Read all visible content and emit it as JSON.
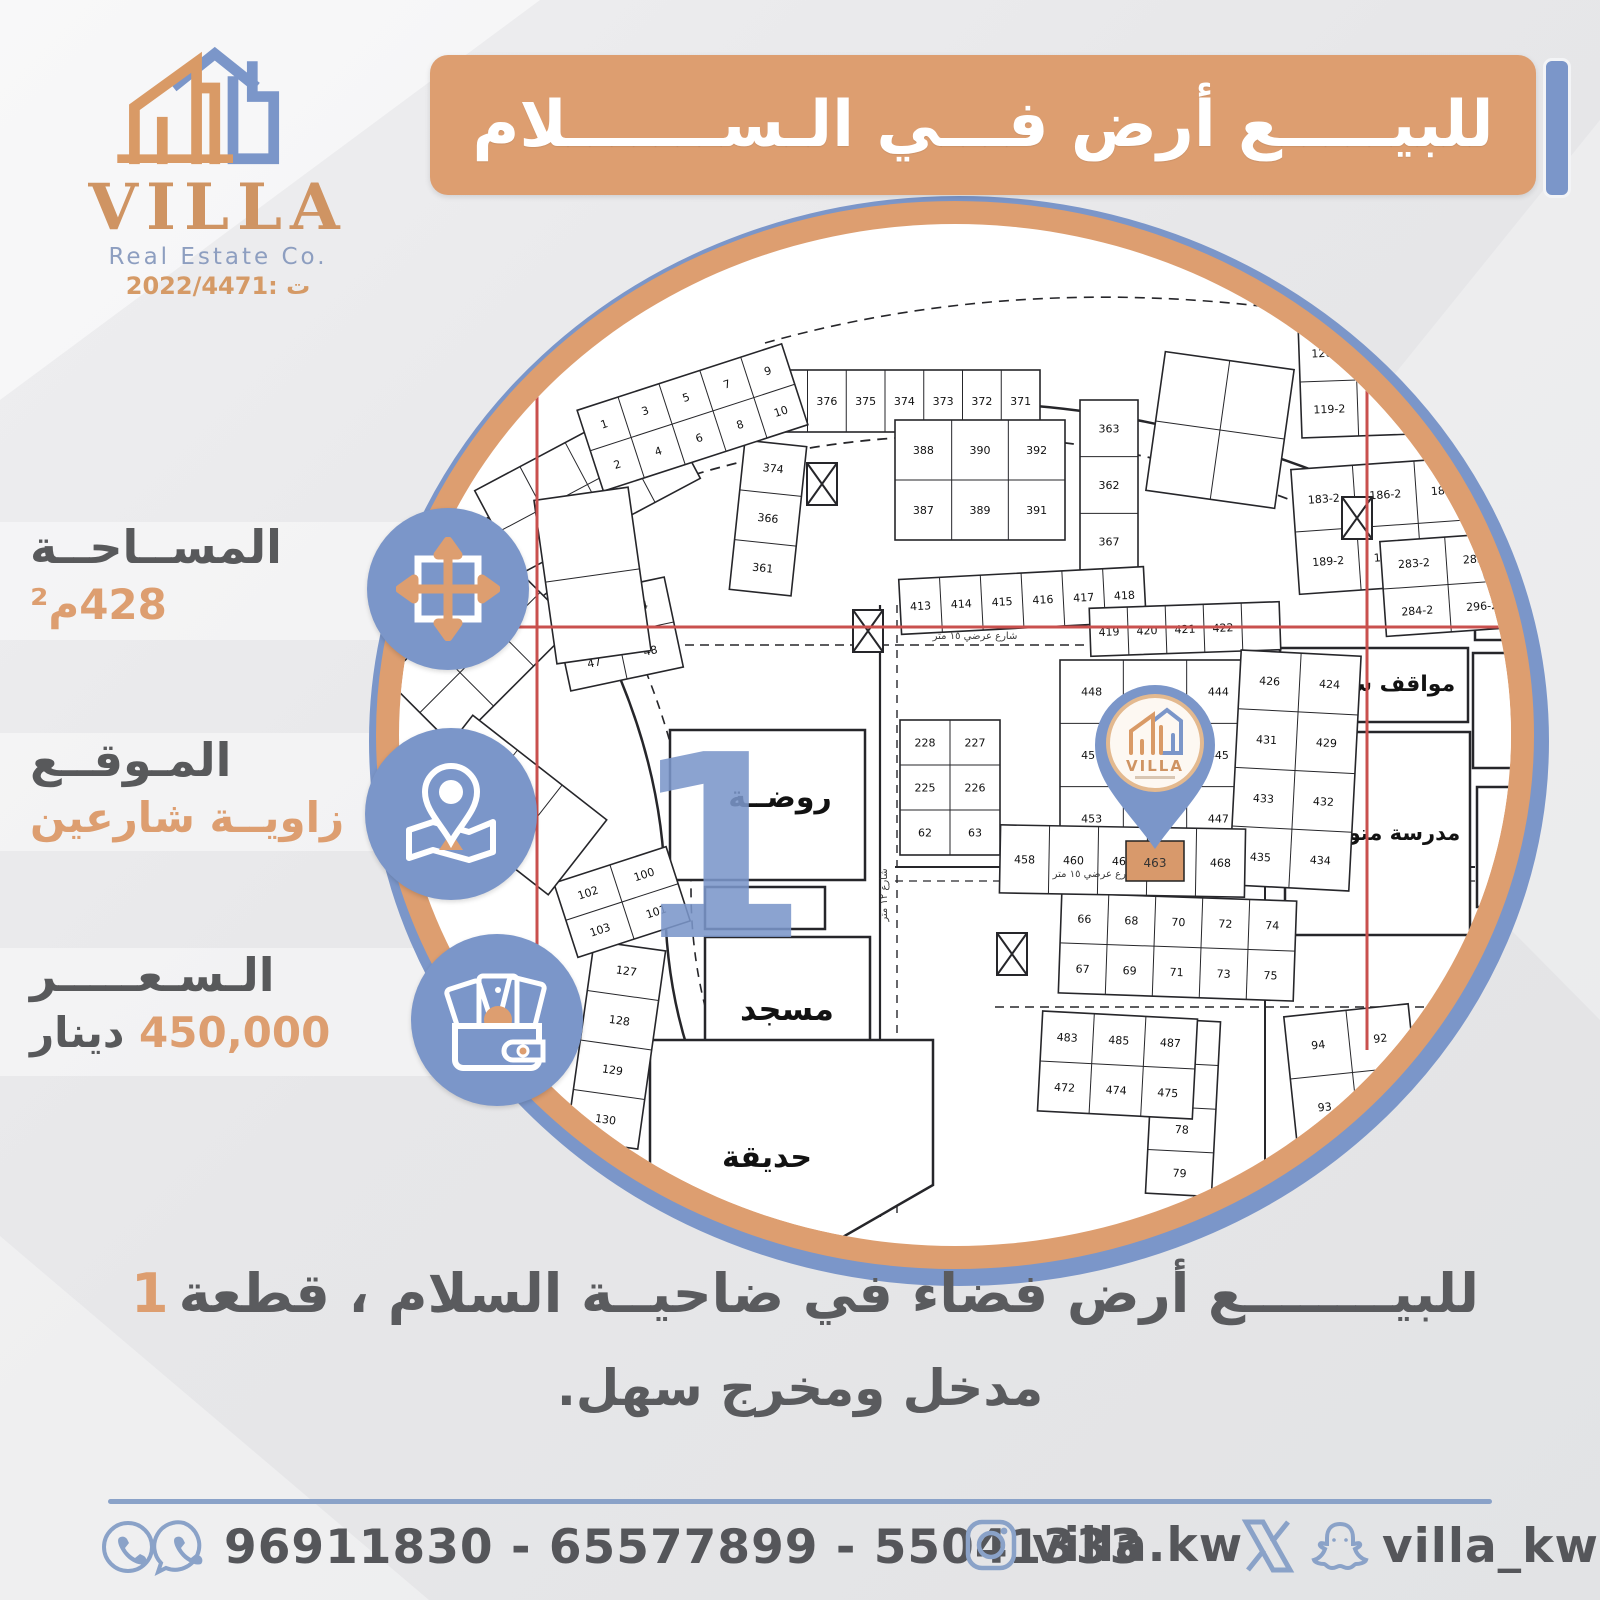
{
  "brand": {
    "name": "VILLA",
    "subtitle": "Real Estate Co.",
    "license": "ت :2022/4471"
  },
  "title_banner": {
    "text": "للبيـــــع أرض فـــي الـســـــــلام"
  },
  "info_items": {
    "area": {
      "label": "المســاحــة",
      "value": "428م²"
    },
    "location": {
      "label": "المـوقــع",
      "value": "زاويــة شارعين"
    },
    "price": {
      "label": "الـسـعـــــر",
      "value": "450,000",
      "unit": "دينار"
    }
  },
  "description": {
    "line1": "للبيــــــــع أرض فضاء في ضاحيــة السلام ، قطعة",
    "plot_number": "1",
    "line2": "مدخل ومخرج سهل."
  },
  "footer": {
    "phones": "96911830 - 65577899 - 55041333",
    "instagram_handle": "villa.kw",
    "social_handle": "villa_kw"
  },
  "colors": {
    "accent_orange": "#dd9e70",
    "accent_blue": "#7b96c9",
    "text_dark": "#58595b",
    "footer_blue": "#8aa2c8",
    "red_line": "#c9504e"
  },
  "map": {
    "big_one": {
      "text": "1",
      "x": 385,
      "y": 762,
      "size": 255
    },
    "pin_parcel_number": "463",
    "zones": [
      {
        "label": "روضــة",
        "x": 335,
        "y": 555,
        "w": 195,
        "h": 150,
        "lx": 445,
        "ly": 632,
        "fs": 30
      },
      {
        "label": "",
        "x": 370,
        "y": 712,
        "w": 120,
        "h": 42,
        "lx": 0,
        "ly": 0,
        "fs": 0
      },
      {
        "label": "مسجد",
        "x": 370,
        "y": 762,
        "w": 165,
        "h": 145,
        "lx": 452,
        "ly": 845,
        "fs": 32
      },
      {
        "label": "حديقة",
        "points": "315,865 598,865 598,1010 480,1078 315,1060",
        "lx": 432,
        "ly": 992,
        "fs": 30
      },
      {
        "label": "مواقف سيارات",
        "x": 945,
        "y": 473,
        "w": 188,
        "h": 74,
        "lx": 1038,
        "ly": 516,
        "fs": 22
      },
      {
        "label": "مدرسة متوسطة",
        "x": 950,
        "y": 557,
        "w": 185,
        "h": 203,
        "lx": 1042,
        "ly": 665,
        "fs": 21
      },
      {
        "label": "",
        "x": 1140,
        "y": 300,
        "w": 125,
        "h": 165,
        "lx": 0,
        "ly": 0,
        "fs": 0
      },
      {
        "label": "",
        "x": 1138,
        "y": 478,
        "w": 70,
        "h": 115,
        "lx": 0,
        "ly": 0,
        "fs": 0
      },
      {
        "label": "",
        "x": 1142,
        "y": 612,
        "w": 72,
        "h": 120,
        "lx": 0,
        "ly": 0,
        "fs": 0
      }
    ],
    "parcel_groups": [
      [
        395,
        195,
        310,
        62,
        1,
        8,
        0,
        [
          "378",
          "377",
          "376",
          "375",
          "374",
          "373",
          "372",
          "371"
        ]
      ],
      [
        402,
        268,
        62,
        150,
        3,
        1,
        6,
        [
          "374",
          "366",
          "361"
        ]
      ],
      [
        560,
        245,
        170,
        120,
        2,
        3,
        0,
        [
          "388",
          "390",
          "392",
          "387",
          "389",
          "391"
        ]
      ],
      [
        745,
        225,
        58,
        170,
        3,
        1,
        0,
        [
          "363",
          "362",
          "367"
        ]
      ],
      [
        820,
        185,
        130,
        140,
        2,
        2,
        8,
        []
      ],
      [
        965,
        148,
        170,
        112,
        2,
        3,
        -2,
        [
          "126-2",
          "123-2",
          "121-2",
          "119-2"
        ]
      ],
      [
        960,
        288,
        185,
        125,
        2,
        3,
        -4,
        [
          "183-2",
          "186-2",
          "184-2",
          "189-2",
          "187-2",
          "185-2"
        ]
      ],
      [
        1048,
        362,
        130,
        95,
        2,
        2,
        -4,
        [
          "283-2",
          "285-2",
          "284-2",
          "296-2"
        ]
      ],
      [
        565,
        398,
        245,
        55,
        1,
        6,
        -3,
        [
          "413",
          "414",
          "415",
          "416",
          "417",
          "418"
        ]
      ],
      [
        755,
        430,
        190,
        48,
        1,
        5,
        -2,
        [
          "419",
          "420",
          "421",
          "422",
          ""
        ]
      ],
      [
        725,
        485,
        190,
        190,
        3,
        3,
        0,
        [
          "448",
          "446",
          "444",
          "451",
          "449",
          "445",
          "453",
          "455",
          "447"
        ]
      ],
      [
        900,
        478,
        120,
        235,
        4,
        2,
        3,
        [
          "426",
          "424",
          "431",
          "429",
          "433",
          "432",
          "435",
          "434"
        ]
      ],
      [
        565,
        545,
        100,
        135,
        3,
        2,
        0,
        [
          "228",
          "227",
          "225",
          "226",
          "62",
          "63"
        ]
      ],
      [
        245,
        770,
        72,
        200,
        4,
        1,
        8,
        [
          "127",
          "128",
          "129",
          "130"
        ]
      ],
      [
        228,
        688,
        118,
        78,
        2,
        2,
        -18,
        [
          "102",
          "100",
          "103",
          "101"
        ]
      ],
      [
        725,
        722,
        235,
        100,
        2,
        5,
        2,
        [
          "66",
          "68",
          "70",
          "72",
          "74",
          "67",
          "69",
          "71",
          "73",
          "75"
        ]
      ],
      [
        815,
        845,
        66,
        175,
        4,
        1,
        3,
        [
          "76",
          "77",
          "78",
          "79"
        ]
      ],
      [
        955,
        835,
        125,
        125,
        2,
        2,
        -6,
        [
          "94",
          "92",
          "93",
          "91"
        ]
      ],
      [
        705,
        840,
        155,
        100,
        2,
        3,
        3,
        [
          "483",
          "485",
          "487",
          "472",
          "474",
          "475"
        ]
      ],
      [
        665,
        652,
        245,
        68,
        1,
        5,
        1,
        [
          "458",
          "460",
          "461",
          "466",
          "468"
        ]
      ],
      [
        225,
        413,
        115,
        92,
        2,
        2,
        -12,
        [
          "46",
          "44",
          "47",
          "48"
        ]
      ],
      [
        95,
        335,
        170,
        95,
        2,
        3,
        -38,
        []
      ],
      [
        150,
        262,
        205,
        95,
        2,
        4,
        -28,
        []
      ],
      [
        250,
        200,
        215,
        85,
        2,
        5,
        -18,
        [
          "1",
          "3",
          "5",
          "7",
          "9",
          "2",
          "4",
          "6",
          "8",
          "10"
        ]
      ],
      [
        60,
        430,
        170,
        95,
        2,
        3,
        -45,
        []
      ],
      [
        128,
        545,
        95,
        170,
        3,
        1,
        -52,
        []
      ],
      [
        210,
        318,
        95,
        165,
        2,
        1,
        -8,
        []
      ]
    ],
    "xboxes": [
      {
        "x": 472,
        "y": 288
      },
      {
        "x": 518,
        "y": 435
      },
      {
        "x": 1007,
        "y": 322
      },
      {
        "x": 662,
        "y": 758
      }
    ],
    "streets": [
      {
        "d": "M 120,360 Q 620,95 1120,360",
        "w": 2.5
      },
      {
        "d": "M 140,392 Q 620,130 1100,392",
        "w": 1.8,
        "dash": "10 7"
      },
      {
        "d": "M 175,315 Q 330,520 330,720 Q 330,905 445,1038",
        "w": 2.5
      },
      {
        "d": "M 202,300 Q 356,520 356,714 Q 356,888 468,1016",
        "w": 1.6,
        "dash": "9 7"
      },
      {
        "d": "M 545,430 L 545,1042",
        "w": 2.2
      },
      {
        "d": "M 562,430 L 562,1042",
        "w": 1.4,
        "dash": "8 7"
      },
      {
        "d": "M 200,470 L 940,470",
        "w": 1.6,
        "dash": "9 6"
      },
      {
        "d": "M 560,692 L 1140,692",
        "w": 2
      },
      {
        "d": "M 560,706 L 1140,706",
        "w": 1.3,
        "dash": "8 6"
      },
      {
        "d": "M 660,832 L 1140,832",
        "w": 1.6,
        "dash": "9 6"
      },
      {
        "d": "M 930,455 L 930,1040",
        "w": 2
      },
      {
        "d": "M 990,1062 L 1137,772",
        "w": 2.2
      },
      {
        "d": "M 1016,1072 L 1162,786",
        "w": 2.2
      },
      {
        "d": "M 430,168 Q 700,92 1005,142",
        "w": 1.6,
        "dash": "10 7"
      }
    ],
    "street_labels": [
      {
        "t": "شارع عرضي ١٥ متر",
        "x": 640,
        "y": 464,
        "r": 0
      },
      {
        "t": "شارع عرضي ١٥ متر",
        "x": 760,
        "y": 702,
        "r": 0
      },
      {
        "t": "شارع ١٢ متر",
        "x": 552,
        "y": 720,
        "r": -90
      }
    ],
    "red_lines": [
      [
        202,
        215,
        202,
        905
      ],
      [
        1032,
        212,
        1032,
        875
      ],
      [
        173,
        452,
        1178,
        452
      ]
    ]
  }
}
